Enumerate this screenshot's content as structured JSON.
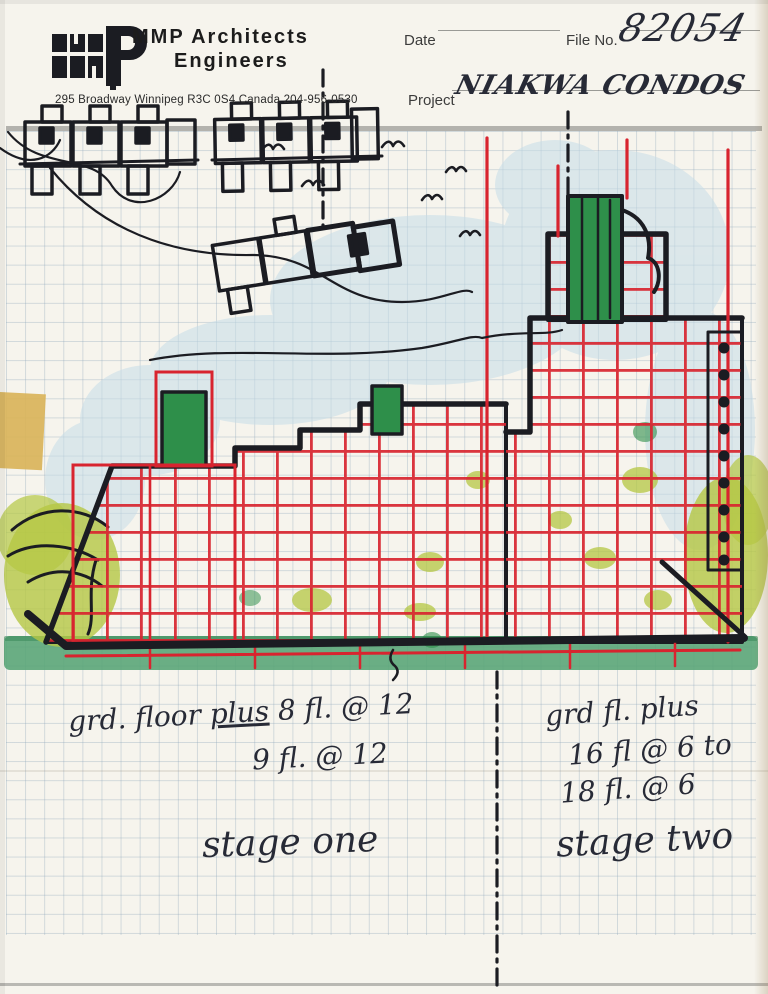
{
  "letterhead": {
    "firm_name_line1": "MMP  Architects",
    "firm_name_line2": "Engineers",
    "address": "295 Broadway Winnipeg R3C 0S4 Canada 204-956-0530"
  },
  "form": {
    "date_label": "Date",
    "date_value": "",
    "file_no_label": "File No.",
    "file_no_value": "82054",
    "project_label": "Project",
    "project_value": "NIAKWA CONDOS"
  },
  "annotations": {
    "stage_one_note": {
      "lead": "grd. floor ",
      "underlined": "plus",
      "tail": " 8 fl. @ 12",
      "line2": "9 fl. @ 12"
    },
    "stage_two_note": {
      "line1": "grd fl. plus",
      "line2": "16 fl @ 6 to",
      "line3": "18 fl. @ 6"
    },
    "stage_one_label": "stage one",
    "stage_two_label": "stage two"
  },
  "colors": {
    "paper": "#f6f4ed",
    "grid_blue": "#8ca5b9",
    "black_ink": "#1b1c22",
    "red_marker": "#d8242f",
    "green_marker": "#2e8f4a",
    "lime_marker": "#b5c743",
    "sky_wash": "#c6dde8",
    "ground_green": "#57a475",
    "tape": "#d9b356",
    "hand_ink": "#272a36"
  }
}
